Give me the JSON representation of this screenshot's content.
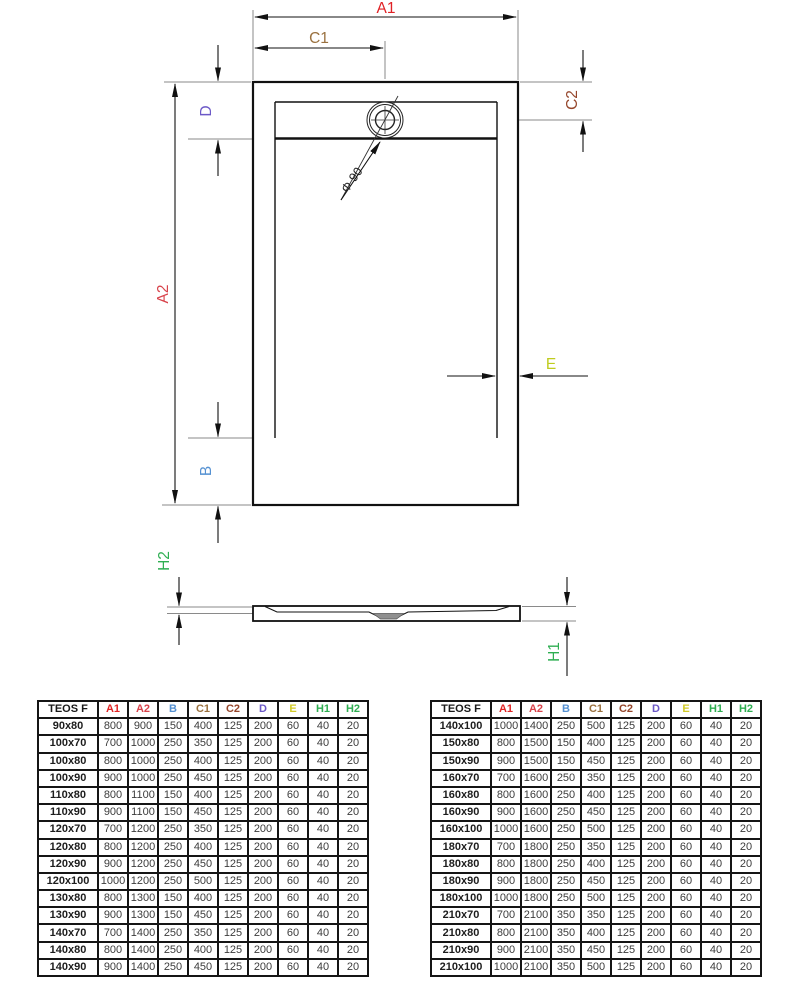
{
  "diagram": {
    "labels": {
      "a1": {
        "text": "A1",
        "color": "#e02125"
      },
      "a2": {
        "text": "A2",
        "color": "#d8434b"
      },
      "b": {
        "text": "B",
        "color": "#5591d2"
      },
      "c1": {
        "text": "C1",
        "color": "#9a713f"
      },
      "c2": {
        "text": "C2",
        "color": "#95462b"
      },
      "d": {
        "text": "D",
        "color": "#6c59c7"
      },
      "e": {
        "text": "E",
        "color": "#bfcc1e"
      },
      "h1": {
        "text": "H1",
        "color": "#2fae52"
      },
      "h2": {
        "text": "H2",
        "color": "#2fae52"
      },
      "drain_diameter": {
        "text": "Φ 90",
        "color": "#222222"
      }
    }
  },
  "tables": {
    "header_colors": [
      "#1a1a1a",
      "#e02525",
      "#d8434b",
      "#5591d2",
      "#9a713f",
      "#95462b",
      "#6c59c7",
      "#d2cb28",
      "#2fae52",
      "#2fae52"
    ],
    "left": {
      "header": [
        "TEOS F",
        "A1",
        "A2",
        "B",
        "C1",
        "C2",
        "D",
        "E",
        "H1",
        "H2"
      ],
      "rows": [
        [
          "90x80",
          "800",
          "900",
          "150",
          "400",
          "125",
          "200",
          "60",
          "40",
          "20"
        ],
        [
          "100x70",
          "700",
          "1000",
          "250",
          "350",
          "125",
          "200",
          "60",
          "40",
          "20"
        ],
        [
          "100x80",
          "800",
          "1000",
          "250",
          "400",
          "125",
          "200",
          "60",
          "40",
          "20"
        ],
        [
          "100x90",
          "900",
          "1000",
          "250",
          "450",
          "125",
          "200",
          "60",
          "40",
          "20"
        ],
        [
          "110x80",
          "800",
          "1100",
          "150",
          "400",
          "125",
          "200",
          "60",
          "40",
          "20"
        ],
        [
          "110x90",
          "900",
          "1100",
          "150",
          "450",
          "125",
          "200",
          "60",
          "40",
          "20"
        ],
        [
          "120x70",
          "700",
          "1200",
          "250",
          "350",
          "125",
          "200",
          "60",
          "40",
          "20"
        ],
        [
          "120x80",
          "800",
          "1200",
          "250",
          "400",
          "125",
          "200",
          "60",
          "40",
          "20"
        ],
        [
          "120x90",
          "900",
          "1200",
          "250",
          "450",
          "125",
          "200",
          "60",
          "40",
          "20"
        ],
        [
          "120x100",
          "1000",
          "1200",
          "250",
          "500",
          "125",
          "200",
          "60",
          "40",
          "20"
        ],
        [
          "130x80",
          "800",
          "1300",
          "150",
          "400",
          "125",
          "200",
          "60",
          "40",
          "20"
        ],
        [
          "130x90",
          "900",
          "1300",
          "150",
          "450",
          "125",
          "200",
          "60",
          "40",
          "20"
        ],
        [
          "140x70",
          "700",
          "1400",
          "250",
          "350",
          "125",
          "200",
          "60",
          "40",
          "20"
        ],
        [
          "140x80",
          "800",
          "1400",
          "250",
          "400",
          "125",
          "200",
          "60",
          "40",
          "20"
        ],
        [
          "140x90",
          "900",
          "1400",
          "250",
          "450",
          "125",
          "200",
          "60",
          "40",
          "20"
        ]
      ]
    },
    "right": {
      "header": [
        "TEOS F",
        "A1",
        "A2",
        "B",
        "C1",
        "C2",
        "D",
        "E",
        "H1",
        "H2"
      ],
      "rows": [
        [
          "140x100",
          "1000",
          "1400",
          "250",
          "500",
          "125",
          "200",
          "60",
          "40",
          "20"
        ],
        [
          "150x80",
          "800",
          "1500",
          "150",
          "400",
          "125",
          "200",
          "60",
          "40",
          "20"
        ],
        [
          "150x90",
          "900",
          "1500",
          "150",
          "450",
          "125",
          "200",
          "60",
          "40",
          "20"
        ],
        [
          "160x70",
          "700",
          "1600",
          "250",
          "350",
          "125",
          "200",
          "60",
          "40",
          "20"
        ],
        [
          "160x80",
          "800",
          "1600",
          "250",
          "400",
          "125",
          "200",
          "60",
          "40",
          "20"
        ],
        [
          "160x90",
          "900",
          "1600",
          "250",
          "450",
          "125",
          "200",
          "60",
          "40",
          "20"
        ],
        [
          "160x100",
          "1000",
          "1600",
          "250",
          "500",
          "125",
          "200",
          "60",
          "40",
          "20"
        ],
        [
          "180x70",
          "700",
          "1800",
          "250",
          "350",
          "125",
          "200",
          "60",
          "40",
          "20"
        ],
        [
          "180x80",
          "800",
          "1800",
          "250",
          "400",
          "125",
          "200",
          "60",
          "40",
          "20"
        ],
        [
          "180x90",
          "900",
          "1800",
          "250",
          "450",
          "125",
          "200",
          "60",
          "40",
          "20"
        ],
        [
          "180x100",
          "1000",
          "1800",
          "250",
          "500",
          "125",
          "200",
          "60",
          "40",
          "20"
        ],
        [
          "210x70",
          "700",
          "2100",
          "350",
          "350",
          "125",
          "200",
          "60",
          "40",
          "20"
        ],
        [
          "210x80",
          "800",
          "2100",
          "350",
          "400",
          "125",
          "200",
          "60",
          "40",
          "20"
        ],
        [
          "210x90",
          "900",
          "2100",
          "350",
          "450",
          "125",
          "200",
          "60",
          "40",
          "20"
        ],
        [
          "210x100",
          "1000",
          "2100",
          "350",
          "500",
          "125",
          "200",
          "60",
          "40",
          "20"
        ]
      ]
    }
  }
}
